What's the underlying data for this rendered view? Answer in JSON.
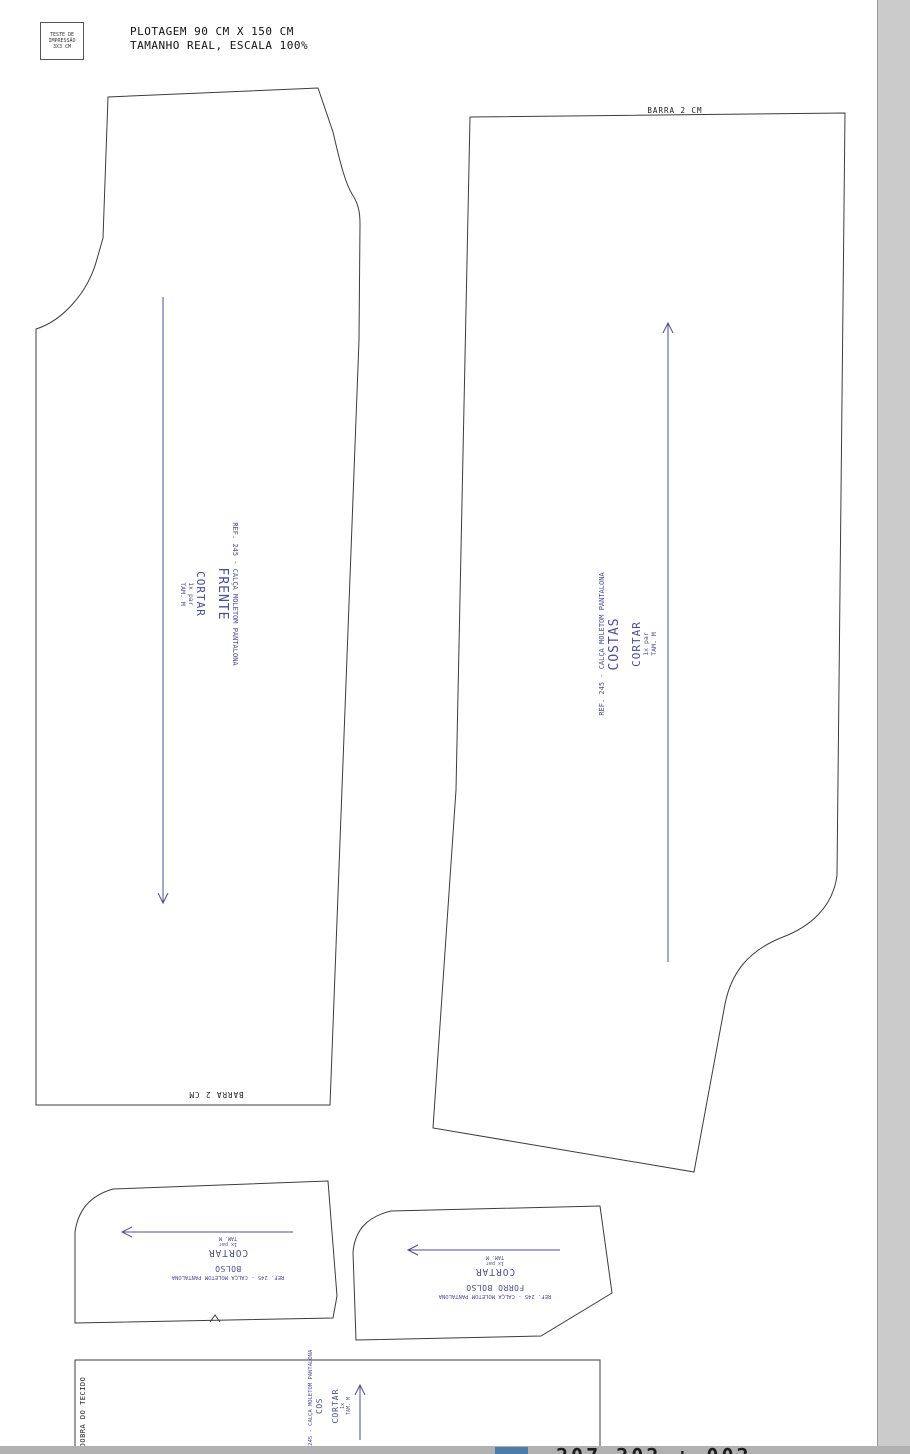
{
  "page": {
    "test_box": {
      "line1": "TESTE DE",
      "line2": "IMPRESSÃO",
      "line3": "3X3 CM"
    },
    "header": {
      "line1": "PLOTAGEM 90 CM X 150 CM",
      "line2": "TAMANHO REAL, ESCALA 100%"
    }
  },
  "pieces": {
    "front": {
      "ref": "REF. 245 - CALÇA MOLETOM PANTALONA",
      "name": "FRENTE",
      "cut": "CORTAR",
      "qty": "1x par",
      "size": "TAM. M",
      "hem": "BARRA 2 CM"
    },
    "back": {
      "ref": "REF. 245 - CALÇA MOLETOM PANTALONA",
      "name": "COSTAS",
      "cut": "CORTAR",
      "qty": "1x par",
      "size": "TAM. M",
      "hem": "BARRA 2 CM"
    },
    "pocket": {
      "ref": "REF. 245 - CALÇA MOLETOM PANTALONA",
      "name": "BOLSO",
      "cut": "CORTAR",
      "qty": "1x par",
      "size": "TAM. M"
    },
    "pocket_lining": {
      "ref": "REF. 245 - CALÇA MOLETOM PANTALONA",
      "name": "FORRO BOLSO",
      "cut": "CORTAR",
      "qty": "1x par",
      "size": "TAM. M"
    },
    "waistband": {
      "ref": "REF. 245 - CALÇA MOLETOM PANTALONA",
      "name": "COS",
      "cut": "CORTAR",
      "qty": "1x",
      "size": "TAM. M",
      "fold": "DOBRA DO TECIDO"
    }
  },
  "footer": {
    "clipped_text": "207 202 + 002"
  },
  "colors": {
    "ink": "#3c3c3c",
    "label": "#4b4b9c",
    "page_bg": "#ffffff",
    "margin_bg": "#cbcbcb",
    "band_bg": "#b1b1b1",
    "chip_blue": "#4d7ca6"
  }
}
